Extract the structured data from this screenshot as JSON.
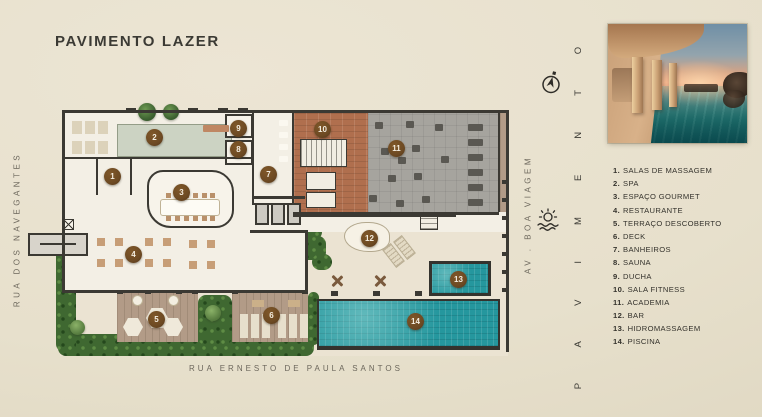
{
  "title": "PAVIMENTO LAZER",
  "streets": {
    "left": "RUA DOS NAVEGANTES",
    "right": "AV . BOA VIAGEM",
    "bottom": "RUA ERNESTO DE PAULA SANTOS"
  },
  "floor_word_vertical": "PAVIMENTO",
  "icons": {
    "compass": "north-arrow-icon",
    "sun": "sunset-over-sea-icon",
    "photo": "pool-sunset-rendering"
  },
  "legend": {
    "items": [
      {
        "n": "1.",
        "label": "SALAS DE MASSAGEM"
      },
      {
        "n": "2.",
        "label": "SPA"
      },
      {
        "n": "3.",
        "label": "ESPAÇO GOURMET"
      },
      {
        "n": "4.",
        "label": "RESTAURANTE"
      },
      {
        "n": "5.",
        "label": "TERRAÇO DESCOBERTO"
      },
      {
        "n": "6.",
        "label": "DECK"
      },
      {
        "n": "7.",
        "label": "BANHEIROS"
      },
      {
        "n": "8.",
        "label": "SAUNA"
      },
      {
        "n": "9.",
        "label": "DUCHA"
      },
      {
        "n": "10.",
        "label": "SALA FITNESS"
      },
      {
        "n": "11.",
        "label": "ACADEMIA"
      },
      {
        "n": "12.",
        "label": "BAR"
      },
      {
        "n": "13.",
        "label": "HIDROMASSAGEM"
      },
      {
        "n": "14.",
        "label": "PISCINA"
      }
    ]
  },
  "plan": {
    "markers": [
      "1",
      "2",
      "3",
      "4",
      "5",
      "6",
      "7",
      "8",
      "9",
      "10",
      "11",
      "12",
      "13",
      "14"
    ]
  },
  "theme": {
    "bg": "#e7e0cc",
    "ink": "#3b3a34",
    "muted": "#6c675c",
    "floor": "#f3efe5",
    "terrace": "#ebe3d2",
    "wall": "#3b3933",
    "marker": "#6d4a23",
    "pool": "#25979e",
    "spa-pool": "#ccd3c3",
    "brick": "#b06f4e",
    "gym": "#a6a49e",
    "wood": "#b29b87",
    "hedge": "#3f6831"
  }
}
